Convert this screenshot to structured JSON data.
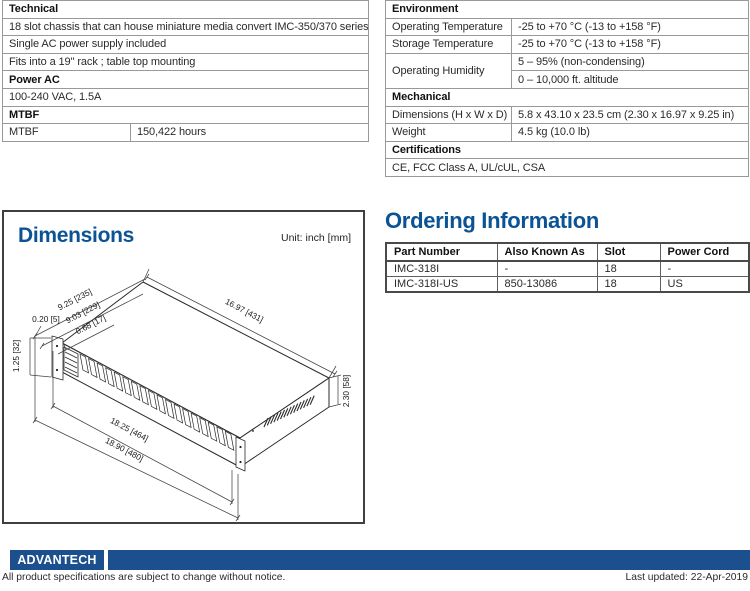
{
  "colors": {
    "accent": "#0b5394",
    "bar": "#1c4f8d"
  },
  "technical": {
    "rows": [
      {
        "label": "Technical"
      },
      {
        "label": "18 slot chassis that can house miniature media convert IMC-350/370 series"
      },
      {
        "label": "Single AC power supply included"
      },
      {
        "label": "Fits into a 19\" rack ; table top mounting"
      },
      {
        "label": "Power AC"
      },
      {
        "label": "100-240 VAC, 1.5A"
      },
      {
        "label": "MTBF"
      },
      {
        "label": "MTBF",
        "value": "150,422 hours"
      }
    ]
  },
  "environment": {
    "rows": [
      {
        "label": "Environment"
      },
      {
        "label": "Operating Temperature",
        "value": "-25 to +70 °C (-13 to +158 °F)"
      },
      {
        "label": "Storage Temperature",
        "value": "-25 to +70 °C (-13 to +158 °F)"
      },
      {
        "label": "Operating Humidity",
        "value": "5 – 95% (non-condensing)"
      },
      {
        "value": "0 – 10,000 ft. altitude"
      },
      {
        "label": "Mechanical"
      },
      {
        "label": "Dimensions (H x W x D)",
        "value": "5.8 x 43.10 x 23.5 cm (2.30 x 16.97 x 9.25 in)"
      },
      {
        "label": "Weight",
        "value": "4.5 kg (10.0 lb)"
      },
      {
        "label": "Certifications"
      },
      {
        "label": "CE, FCC Class A, UL/cUL, CSA"
      }
    ]
  },
  "dimensions": {
    "title": "Dimensions",
    "unit": "Unit: inch [mm]",
    "labels": {
      "depth_outer": "9.25 [235]",
      "depth_inner": "9.03 [229]",
      "ear_offset": "0.68 [17]",
      "step": "0.20 [5]",
      "ear_height": "1.25 [32]",
      "width_top": "16.97 [431]",
      "height": "2.30 [58]",
      "width_front": "18.25 [464]",
      "width_total": "18.90 [480]"
    }
  },
  "ordering": {
    "title": "Ordering Information",
    "headers": [
      "Part Number",
      "Also Known As",
      "Slot",
      "Power Cord"
    ],
    "rows": [
      [
        "IMC-318I",
        "-",
        "18",
        "-"
      ],
      [
        "IMC-318I-US",
        "850-13086",
        "18",
        "US"
      ]
    ]
  },
  "footer": {
    "logo": "ADVANTECH",
    "note": "All product specifications are subject to change without notice.",
    "updated": "Last updated: 22-Apr-2019"
  }
}
